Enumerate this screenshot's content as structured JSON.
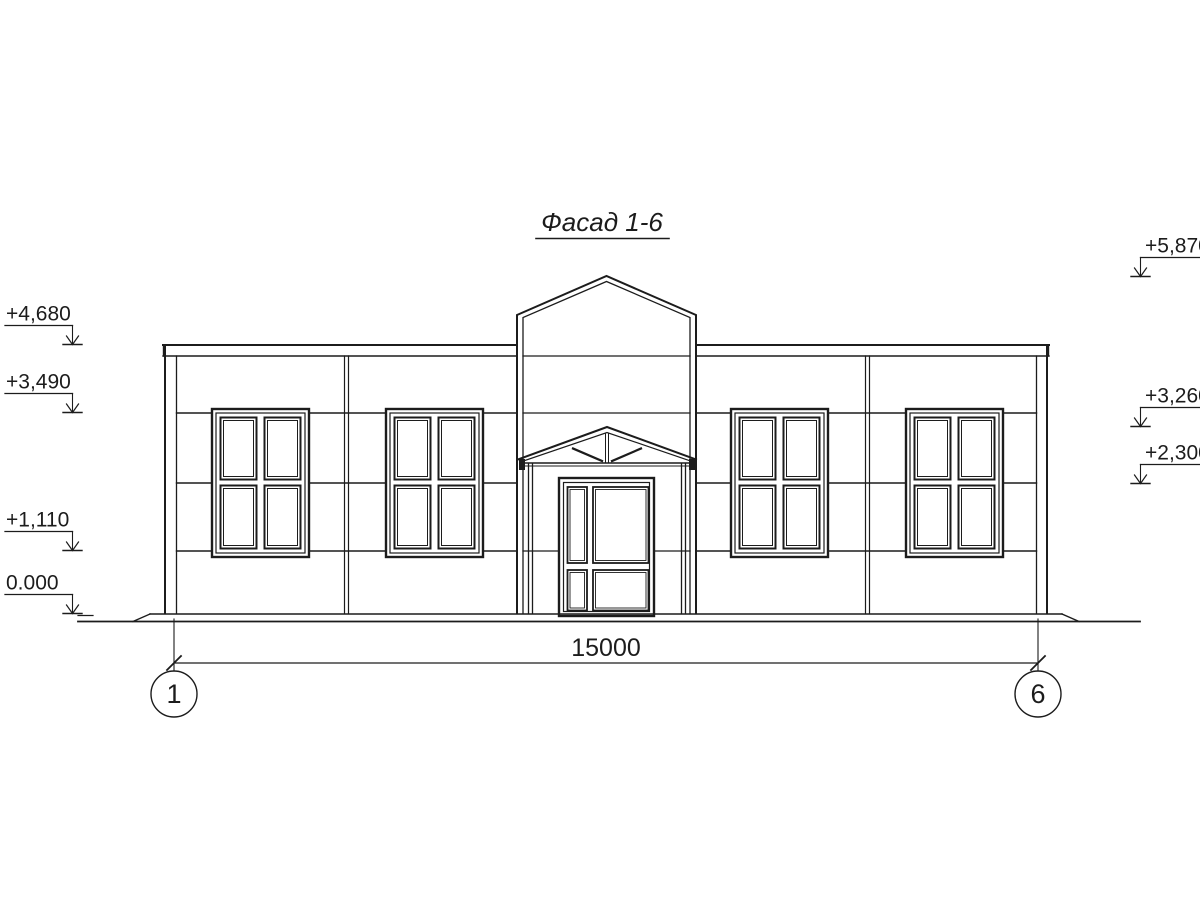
{
  "title": "Фасад 1-6",
  "colors": {
    "line": "#1c1c1c",
    "background": "#ffffff"
  },
  "elevation_marks": {
    "left": [
      "+4,680",
      "+3,490",
      "+1,110",
      "0.000"
    ],
    "right": [
      "+5,870",
      "+3,260",
      "+2,300"
    ]
  },
  "dimension_label": "15000",
  "axis_labels": [
    "1",
    "6"
  ]
}
